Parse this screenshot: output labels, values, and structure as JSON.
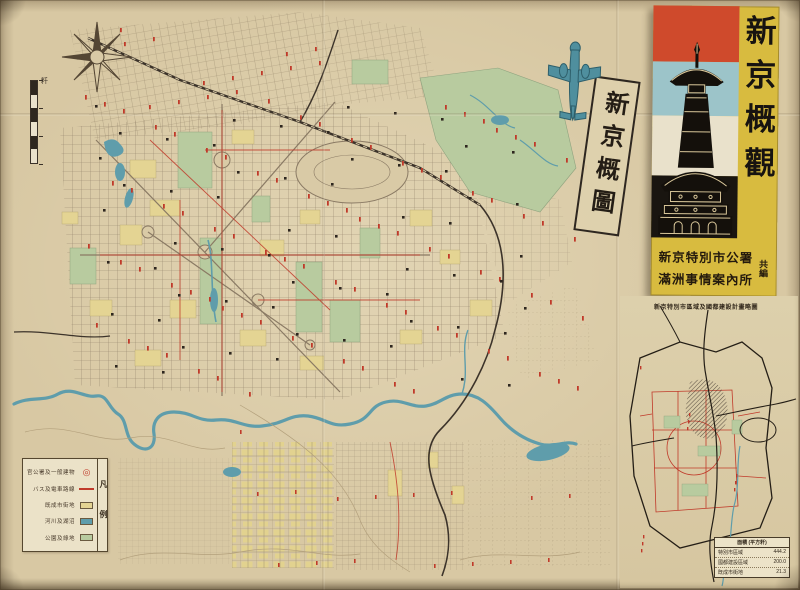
{
  "palette": {
    "paper": "#d8c8a3",
    "ink": "#3a3128",
    "street": "#8d7d64",
    "label_red": "#c03a2a",
    "river_blue": "#5f9dab",
    "park_green": "#b8cb9f",
    "district_yellow": "#e4d493",
    "cover_yellow": "#d8bb3f",
    "cover_red": "#cf4a2c",
    "cover_blue": "#9cc4c9",
    "cover_cream": "#e9e1cb",
    "cover_black": "#191510"
  },
  "map_title_box": {
    "text": "新京概圖"
  },
  "scalebar": {
    "unit": "粁"
  },
  "cover": {
    "title": "新京概觀",
    "publisher_line1": "新京特別市公署",
    "publisher_line2": "滿洲事情案內所",
    "publisher_suffix": "共編",
    "illustration": "memorial-tower-silhouette"
  },
  "legend": {
    "title": "凡例",
    "entries": [
      {
        "label": "官公署及一般建物",
        "symbol": "red-double-circle"
      },
      {
        "label": "バス及電車路線",
        "symbol": "red-line"
      },
      {
        "label": "既成市街地",
        "symbol": "yellow-swatch"
      },
      {
        "label": "河川及湖沼",
        "symbol": "blue-swatch"
      },
      {
        "label": "公園及綠地",
        "symbol": "green-swatch"
      }
    ]
  },
  "inset": {
    "title": "新京特別市區域及國都建設計畫略圖",
    "table": {
      "header": "面積 (平方粁)",
      "rows": [
        [
          "特別市區域",
          "444.2"
        ],
        [
          "國都建設區域",
          "200.0"
        ],
        [
          "既成市街地",
          "21.3"
        ]
      ]
    }
  }
}
